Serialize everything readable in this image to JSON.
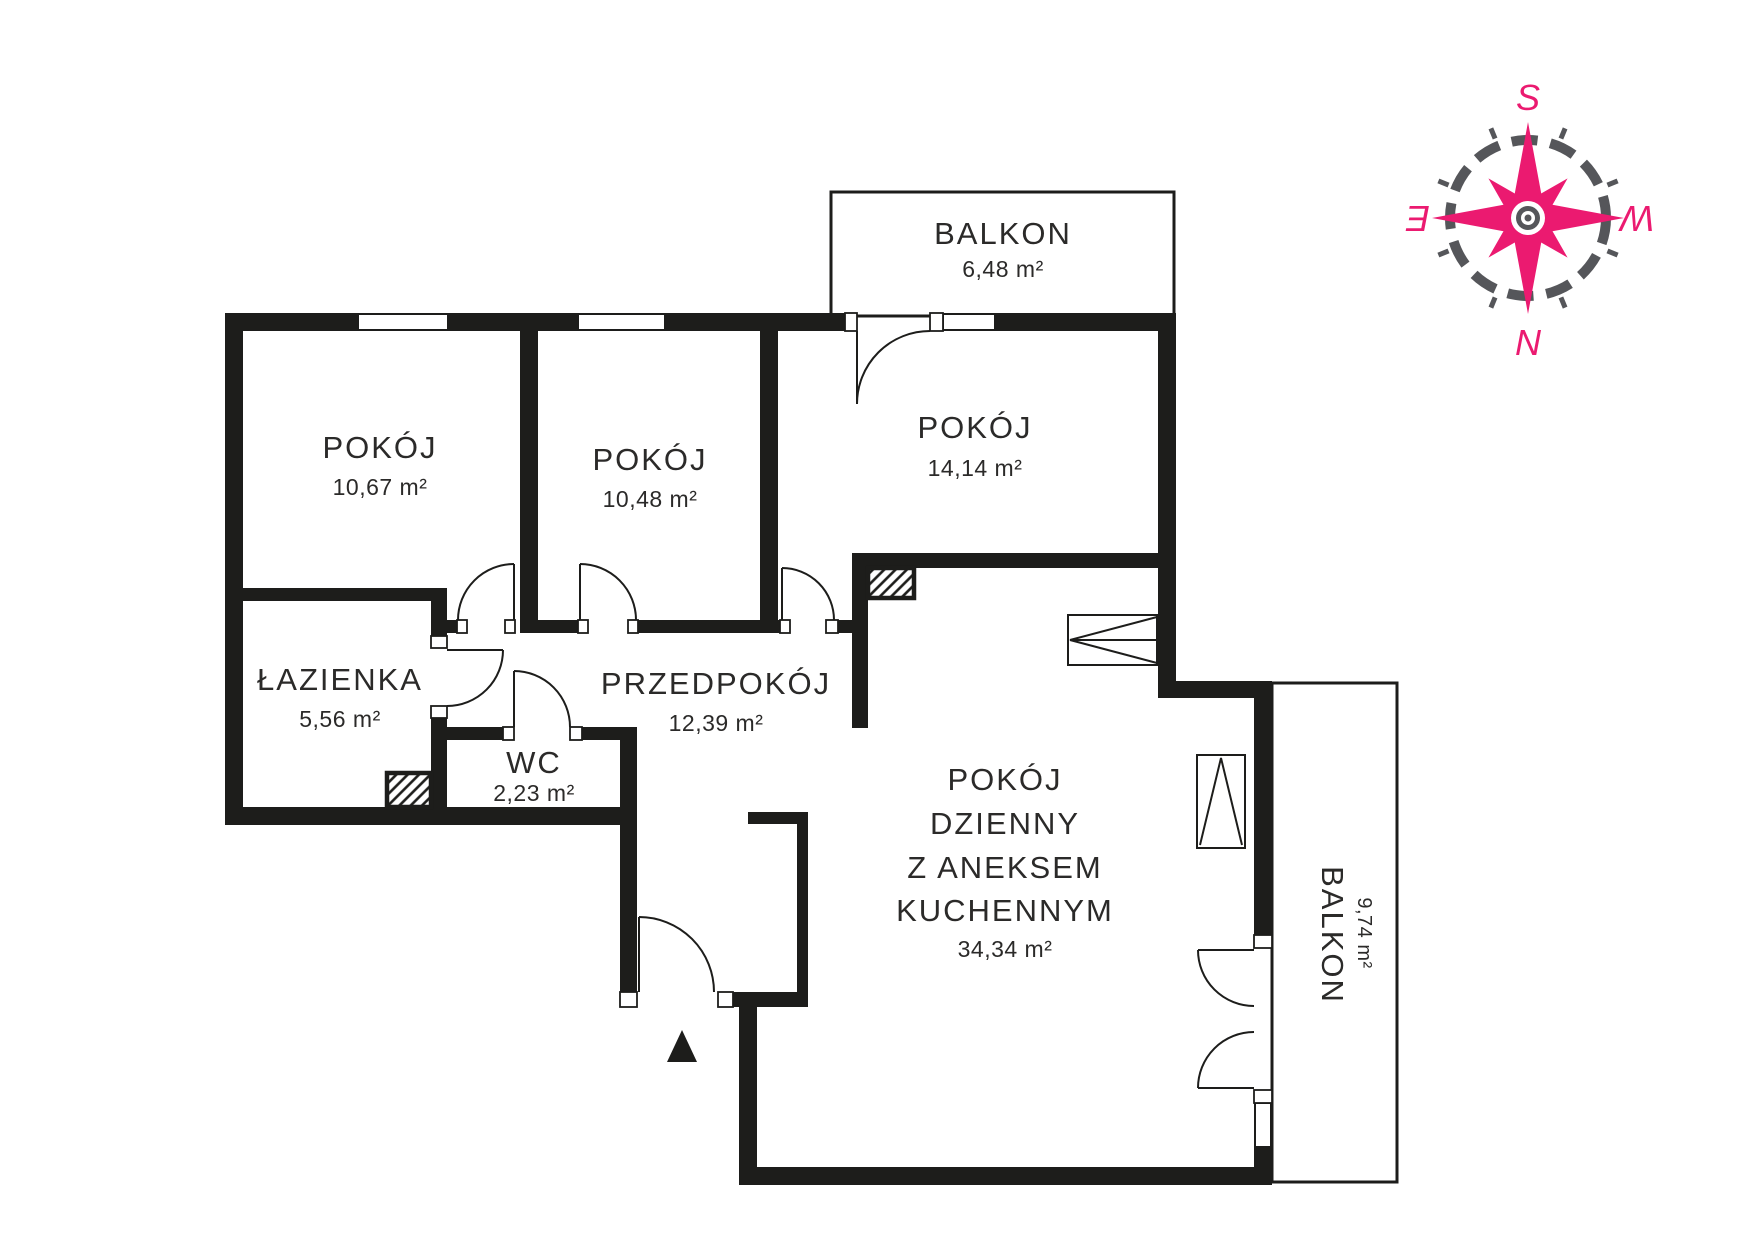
{
  "floorplan": {
    "colors": {
      "wall": "#1d1d1b",
      "text": "#2b2a29",
      "compass_accent": "#eb1a70",
      "compass_ring": "#55565a"
    },
    "rooms": {
      "pokoj1": {
        "label": "POKÓJ",
        "area": "10,67 m²"
      },
      "pokoj2": {
        "label": "POKÓJ",
        "area": "10,48 m²"
      },
      "pokoj3": {
        "label": "POKÓJ",
        "area": "14,14 m²"
      },
      "lazienka": {
        "label": "ŁAZIENKA",
        "area": "5,56 m²"
      },
      "wc": {
        "label": "WC",
        "area": "2,23 m²"
      },
      "przedpokoj": {
        "label": "PRZEDPOKÓJ",
        "area": "12,39 m²"
      },
      "salon": {
        "lines": [
          "POKÓJ",
          "DZIENNY",
          "Z ANEKSEM",
          "KUCHENNYM"
        ],
        "area": "34,34 m²"
      },
      "balkon_top": {
        "label": "BALKON",
        "area": "6,48 m²"
      },
      "balkon_right": {
        "label": "BALKON",
        "area": "9,74 m²"
      }
    },
    "compass": {
      "south": "S",
      "north": "N",
      "east": "E",
      "west": "W"
    }
  }
}
